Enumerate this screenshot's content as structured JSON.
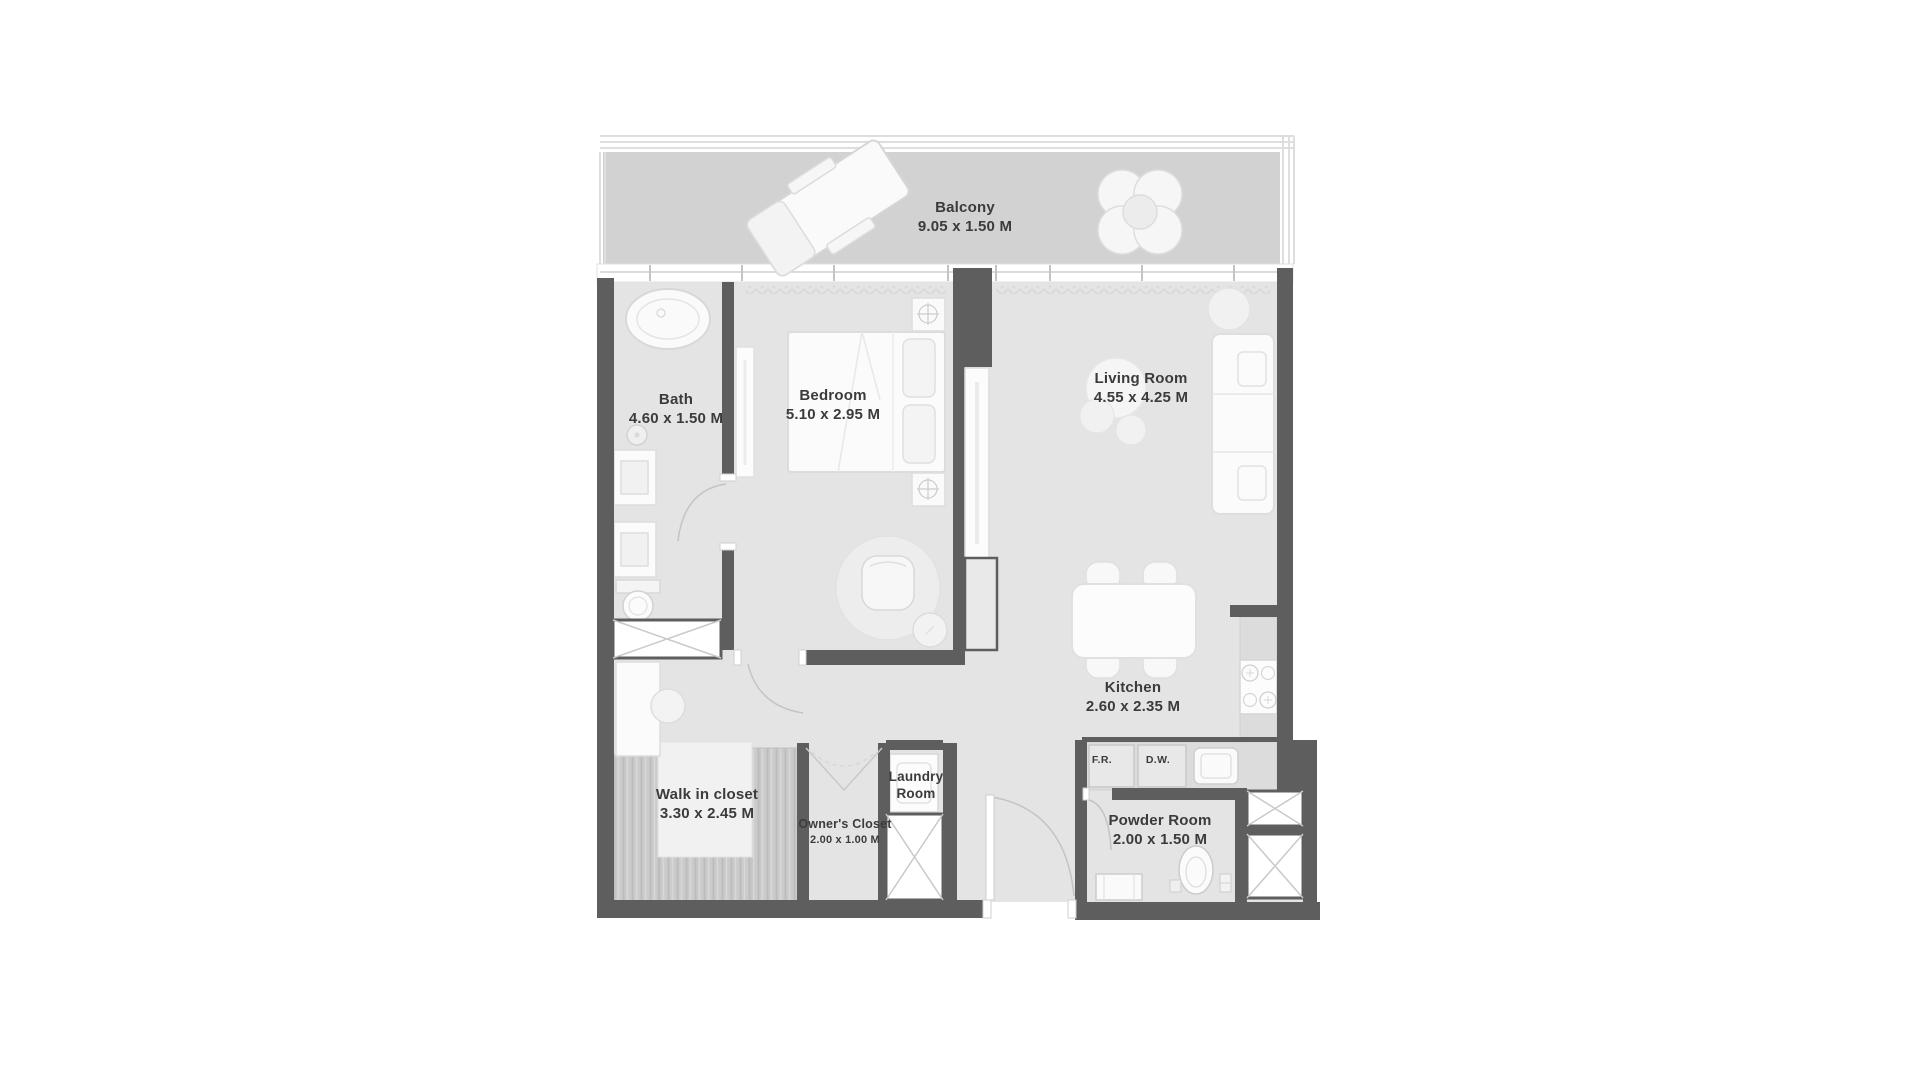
{
  "rooms": [
    {
      "id": "balcony",
      "name": "Balcony",
      "dims": "9.05 x 1.50 M"
    },
    {
      "id": "bath",
      "name": "Bath",
      "dims": "4.60 x 1.50 M"
    },
    {
      "id": "bedroom",
      "name": "Bedroom",
      "dims": "5.10 x 2.95 M"
    },
    {
      "id": "living-room",
      "name": "Living Room",
      "dims": "4.55 x 4.25 M"
    },
    {
      "id": "kitchen",
      "name": "Kitchen",
      "dims": "2.60 x 2.35 M"
    },
    {
      "id": "walk-in-closet",
      "name": "Walk in closet",
      "dims": "3.30 x 2.45 M"
    },
    {
      "id": "owners-closet",
      "name": "Owner's Closet",
      "dims": "2.00 x 1.00 M"
    },
    {
      "id": "laundry-room",
      "line1": "Laundry",
      "line2": "Room"
    },
    {
      "id": "powder-room",
      "name": "Powder Room",
      "dims": "2.00 x 1.50 M"
    }
  ],
  "appliances": [
    {
      "id": "fridge",
      "label": "F.R."
    },
    {
      "id": "dishwasher",
      "label": "D.W."
    }
  ],
  "colors": {
    "wall": "#5e5e5e",
    "floor": "#e4e4e4",
    "balcony_floor": "#d2d2d2",
    "furniture": "#fbfbfb",
    "wardrobe_hatch": "#cbcbcb",
    "text": "#3b3b3b"
  }
}
